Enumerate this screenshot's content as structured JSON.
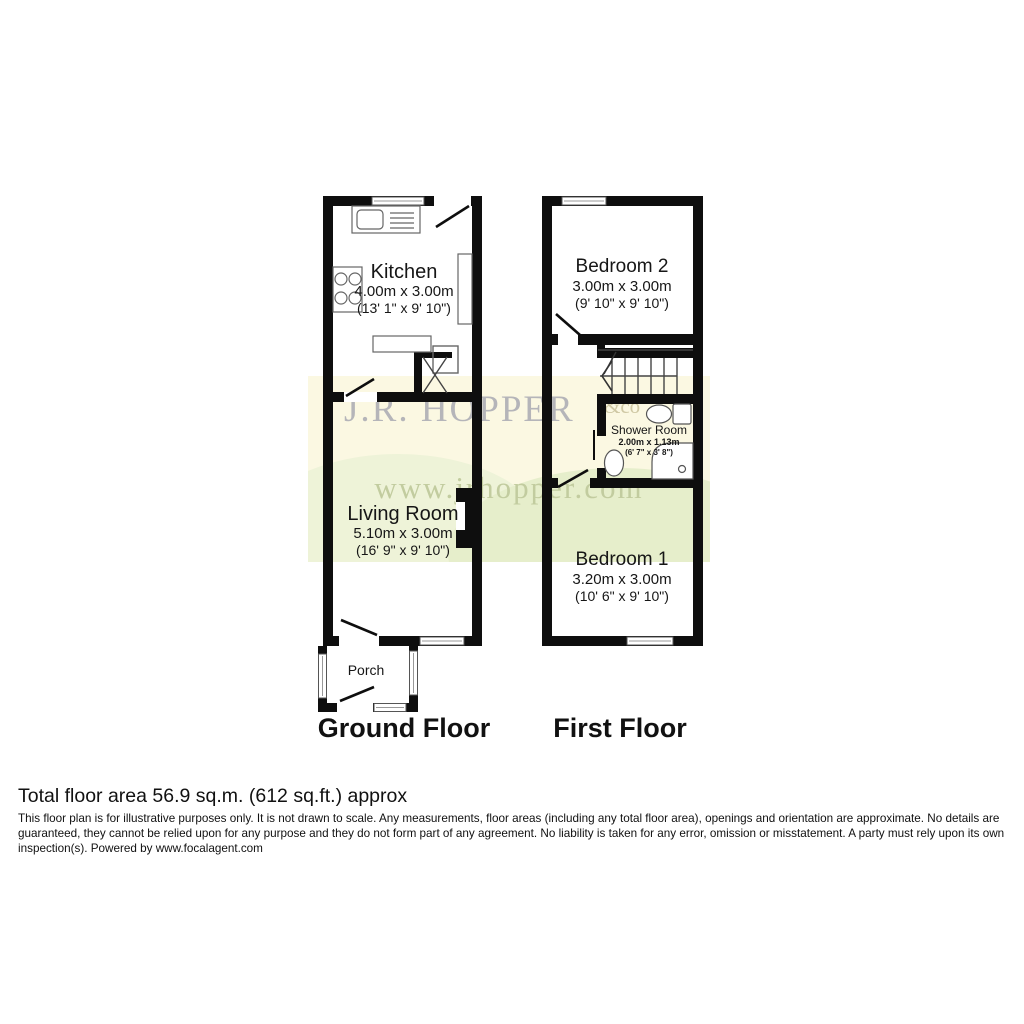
{
  "watermark": {
    "brand": "J.R. HOPPER",
    "suffix": "&co",
    "url": "www.jrhopper.com"
  },
  "ground_floor": {
    "title": "Ground Floor",
    "rooms": {
      "kitchen": {
        "name": "Kitchen",
        "metric": "4.00m x 3.00m",
        "imperial": "(13' 1\" x 9' 10\")"
      },
      "living_room": {
        "name": "Living Room",
        "metric": "5.10m x 3.00m",
        "imperial": "(16' 9\" x 9' 10\")"
      },
      "porch": {
        "name": "Porch"
      }
    }
  },
  "first_floor": {
    "title": "First Floor",
    "rooms": {
      "bedroom2": {
        "name": "Bedroom 2",
        "metric": "3.00m x 3.00m",
        "imperial": "(9' 10\" x 9' 10\")"
      },
      "shower_room": {
        "name": "Shower Room",
        "metric": "2.00m x 1.13m",
        "imperial": "(6' 7\" x 3' 8\")"
      },
      "bedroom1": {
        "name": "Bedroom 1",
        "metric": "3.20m x 3.00m",
        "imperial": "(10' 6\" x 9' 10\")"
      }
    }
  },
  "footer": {
    "total_area": "Total floor area 56.9 sq.m. (612 sq.ft.) approx",
    "disclaimer": "This floor plan is for illustrative purposes only. It is not drawn to scale. Any measurements, floor areas (including any total floor area), openings and orientation are approximate. No details are guaranteed, they cannot be relied upon for any purpose and they do not form part of any agreement. No liability is taken for any error, omission or misstatement. A party must rely upon its own inspection(s). Powered by www.focalagent.com"
  },
  "colors": {
    "wall": "#0e0e0e",
    "watermark_bg": "#fbf8e2",
    "watermark_text": "#b5b5b9",
    "watermark_url": "#c2cc9f",
    "text": "#111111"
  }
}
